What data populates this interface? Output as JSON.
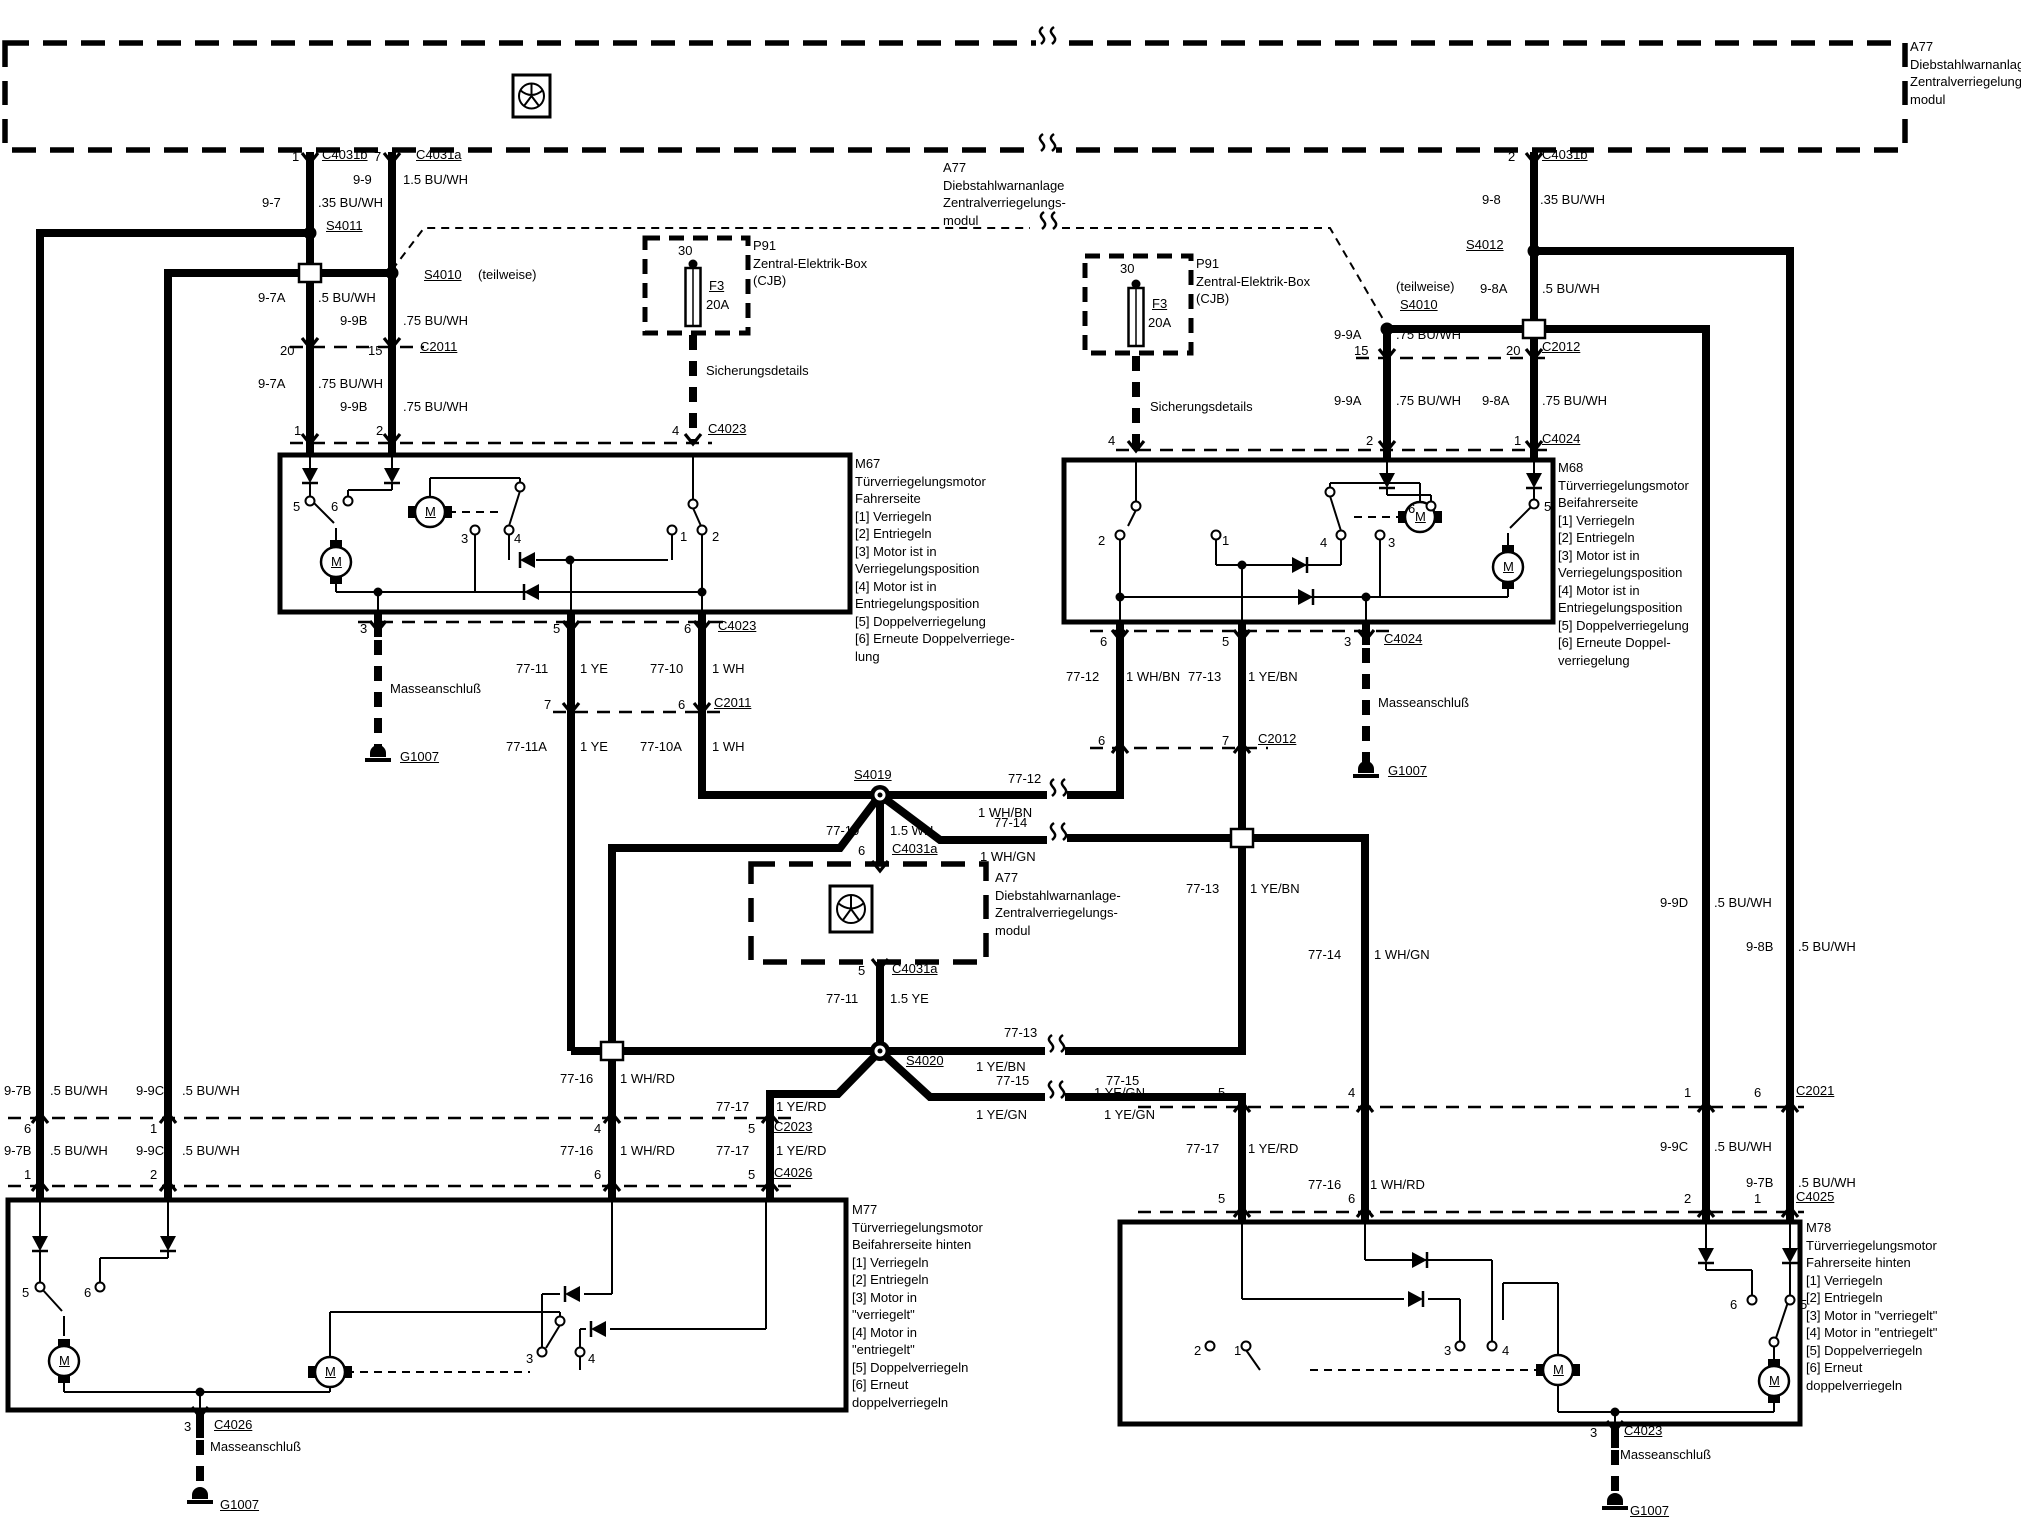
{
  "doc": {
    "type": "wiring-diagram",
    "language": "de",
    "subject": "Diebstahlwarnanlage / Zentralverriegelung (central locking system)",
    "ink": "#000000",
    "paper": "#ffffff"
  },
  "labels": [
    {
      "n": "module-a77-top-text",
      "t": "A77\nDiebstahlwarnanlage-/-\nZentralverriegelungs-\nmodul",
      "x": 1910,
      "y": 47,
      "b": 1
    },
    {
      "n": "module-a77-mid-top-text",
      "t": "A77\nDiebstahlwarnanlage\nZentralverriegelungs-\nmodul",
      "x": 943,
      "y": 168,
      "b": 1
    },
    {
      "n": "pin",
      "t": "1",
      "x": 292,
      "y": 158
    },
    {
      "n": "connector",
      "t": "C4031b",
      "x": 322,
      "y": 156,
      "u": 1
    },
    {
      "n": "pin",
      "t": "7",
      "x": 374,
      "y": 158
    },
    {
      "n": "connector",
      "t": "C4031a",
      "x": 416,
      "y": 156,
      "u": 1
    },
    {
      "n": "circuit",
      "t": "9-9",
      "x": 353,
      "y": 181
    },
    {
      "n": "wire-spec",
      "t": "1.5 BU/WH",
      "x": 403,
      "y": 181
    },
    {
      "n": "circuit",
      "t": "9-7",
      "x": 262,
      "y": 204
    },
    {
      "n": "wire-spec",
      "t": ".35 BU/WH",
      "x": 318,
      "y": 204
    },
    {
      "n": "splice",
      "t": "S4011",
      "x": 326,
      "y": 227,
      "u": 1
    },
    {
      "n": "splice",
      "t": "S4010",
      "x": 424,
      "y": 276,
      "u": 1
    },
    {
      "n": "note",
      "t": "(teilweise)",
      "x": 478,
      "y": 276
    },
    {
      "n": "circuit",
      "t": "9-7A",
      "x": 258,
      "y": 299
    },
    {
      "n": "wire-spec",
      "t": ".5 BU/WH",
      "x": 318,
      "y": 299
    },
    {
      "n": "circuit",
      "t": "9-9B",
      "x": 340,
      "y": 322
    },
    {
      "n": "wire-spec",
      "t": ".75 BU/WH",
      "x": 403,
      "y": 322
    },
    {
      "n": "pin",
      "t": "20",
      "x": 280,
      "y": 352
    },
    {
      "n": "pin",
      "t": "15",
      "x": 368,
      "y": 352
    },
    {
      "n": "connector",
      "t": "C2011",
      "x": 420,
      "y": 348,
      "u": 1
    },
    {
      "n": "circuit",
      "t": "9-7A",
      "x": 258,
      "y": 385
    },
    {
      "n": "wire-spec",
      "t": ".75 BU/WH",
      "x": 318,
      "y": 385
    },
    {
      "n": "circuit",
      "t": "9-9B",
      "x": 340,
      "y": 408
    },
    {
      "n": "wire-spec",
      "t": ".75 BU/WH",
      "x": 403,
      "y": 408
    },
    {
      "n": "pin",
      "t": "1",
      "x": 294,
      "y": 432
    },
    {
      "n": "pin",
      "t": "2",
      "x": 376,
      "y": 432
    },
    {
      "n": "pin",
      "t": "4",
      "x": 672,
      "y": 432
    },
    {
      "n": "connector",
      "t": "C4023",
      "x": 708,
      "y": 430,
      "u": 1
    },
    {
      "n": "fusebox-p91-left-text",
      "t": "P91\nZentral-Elektrik-Box\n(CJB)",
      "x": 753,
      "y": 246,
      "b": 1
    },
    {
      "n": "fuse-terminal",
      "t": "30",
      "x": 678,
      "y": 252
    },
    {
      "n": "fuse-id",
      "t": "F3",
      "x": 709,
      "y": 287,
      "u": 1
    },
    {
      "n": "fuse-rating",
      "t": "20A",
      "x": 706,
      "y": 306
    },
    {
      "n": "note",
      "t": "Sicherungsdetails",
      "x": 706,
      "y": 372
    },
    {
      "n": "module-m67-text",
      "t": "M67\nTürverriegelungsmotor\nFahrerseite\n[1] Verriegeln\n[2] Entriegeln\n[3] Motor ist in\nVerriegelungsposition\n[4] Motor ist in\nEntriegelungsposition\n[5] Doppelverriegelung\n[6] Erneute Doppelverriege-\nlung",
      "x": 855,
      "y": 464,
      "b": 1
    },
    {
      "n": "contact",
      "t": "5",
      "x": 293,
      "y": 508
    },
    {
      "n": "contact",
      "t": "6",
      "x": 331,
      "y": 508
    },
    {
      "n": "motor-letter",
      "t": "M",
      "x": 331,
      "y": 563,
      "u": 1
    },
    {
      "n": "motor-letter",
      "t": "M",
      "x": 425,
      "y": 513,
      "u": 1
    },
    {
      "n": "contact",
      "t": "3",
      "x": 461,
      "y": 540
    },
    {
      "n": "contact",
      "t": "4",
      "x": 514,
      "y": 540
    },
    {
      "n": "contact",
      "t": "1",
      "x": 680,
      "y": 538
    },
    {
      "n": "contact",
      "t": "2",
      "x": 712,
      "y": 538
    },
    {
      "n": "pin",
      "t": "3",
      "x": 360,
      "y": 630
    },
    {
      "n": "pin",
      "t": "5",
      "x": 553,
      "y": 630
    },
    {
      "n": "pin",
      "t": "6",
      "x": 684,
      "y": 630
    },
    {
      "n": "connector",
      "t": "C4023",
      "x": 718,
      "y": 627,
      "u": 1
    },
    {
      "n": "note",
      "t": "Masseanschluß",
      "x": 390,
      "y": 690
    },
    {
      "n": "ground",
      "t": "G1007",
      "x": 400,
      "y": 758,
      "u": 1
    },
    {
      "n": "circuit",
      "t": "77-11",
      "x": 516,
      "y": 670
    },
    {
      "n": "wire-spec",
      "t": "1 YE",
      "x": 580,
      "y": 670
    },
    {
      "n": "circuit",
      "t": "77-10",
      "x": 650,
      "y": 670
    },
    {
      "n": "wire-spec",
      "t": "1 WH",
      "x": 712,
      "y": 670
    },
    {
      "n": "pin",
      "t": "7",
      "x": 544,
      "y": 706
    },
    {
      "n": "pin",
      "t": "6",
      "x": 678,
      "y": 706
    },
    {
      "n": "connector",
      "t": "C2011",
      "x": 714,
      "y": 704,
      "u": 1
    },
    {
      "n": "circuit",
      "t": "77-11A",
      "x": 506,
      "y": 748
    },
    {
      "n": "wire-spec",
      "t": "1 YE",
      "x": 580,
      "y": 748
    },
    {
      "n": "circuit",
      "t": "77-10A",
      "x": 640,
      "y": 748
    },
    {
      "n": "wire-spec",
      "t": "1 WH",
      "x": 712,
      "y": 748
    },
    {
      "n": "splice",
      "t": "S4019",
      "x": 854,
      "y": 776,
      "u": 1
    },
    {
      "n": "circuit",
      "t": "77-12",
      "x": 1008,
      "y": 780
    },
    {
      "n": "wire-spec",
      "t": "1 WH/BN",
      "x": 978,
      "y": 814
    },
    {
      "n": "circuit",
      "t": "77-14",
      "x": 994,
      "y": 824
    },
    {
      "n": "wire-spec",
      "t": "1 WH/GN",
      "x": 980,
      "y": 858
    },
    {
      "n": "circuit",
      "t": "77-10",
      "x": 826,
      "y": 832
    },
    {
      "n": "wire-spec",
      "t": "1.5 WH",
      "x": 890,
      "y": 832
    },
    {
      "n": "pin",
      "t": "6",
      "x": 858,
      "y": 852
    },
    {
      "n": "connector",
      "t": "C4031a",
      "x": 892,
      "y": 850,
      "u": 1
    },
    {
      "n": "module-a77-mid-text",
      "t": "A77\nDiebstahlwarnanlage-\nZentralverriegelungs-\nmodul",
      "x": 995,
      "y": 878,
      "b": 1
    },
    {
      "n": "pin",
      "t": "5",
      "x": 858,
      "y": 972
    },
    {
      "n": "connector",
      "t": "C4031a",
      "x": 892,
      "y": 970,
      "u": 1
    },
    {
      "n": "circuit",
      "t": "77-11",
      "x": 826,
      "y": 1000
    },
    {
      "n": "wire-spec",
      "t": "1.5 YE",
      "x": 890,
      "y": 1000
    },
    {
      "n": "splice",
      "t": "S4020",
      "x": 906,
      "y": 1062,
      "u": 1
    },
    {
      "n": "circuit",
      "t": "77-13",
      "x": 1004,
      "y": 1034
    },
    {
      "n": "wire-spec",
      "t": "1 YE/BN",
      "x": 976,
      "y": 1068
    },
    {
      "n": "circuit",
      "t": "77-15",
      "x": 996,
      "y": 1082
    },
    {
      "n": "wire-spec",
      "t": "1 YE/GN",
      "x": 976,
      "y": 1116
    },
    {
      "n": "circuit",
      "t": "77-15",
      "x": 1106,
      "y": 1082
    },
    {
      "n": "wire-spec",
      "t": "1 YE/GN",
      "x": 1104,
      "y": 1116
    },
    {
      "n": "circuit",
      "t": "77-16",
      "x": 560,
      "y": 1080
    },
    {
      "n": "wire-spec",
      "t": "1 WH/RD",
      "x": 620,
      "y": 1080
    },
    {
      "n": "circuit",
      "t": "77-17",
      "x": 716,
      "y": 1108
    },
    {
      "n": "wire-spec",
      "t": "1 YE/RD",
      "x": 776,
      "y": 1108
    },
    {
      "n": "circuit",
      "t": "9-7B",
      "x": 4,
      "y": 1092
    },
    {
      "n": "wire-spec",
      "t": ".5 BU/WH",
      "x": 50,
      "y": 1092
    },
    {
      "n": "circuit",
      "t": "9-9C",
      "x": 136,
      "y": 1092
    },
    {
      "n": "wire-spec",
      "t": ".5 BU/WH",
      "x": 182,
      "y": 1092
    },
    {
      "n": "pin",
      "t": "6",
      "x": 24,
      "y": 1130
    },
    {
      "n": "pin",
      "t": "1",
      "x": 150,
      "y": 1130
    },
    {
      "n": "pin",
      "t": "4",
      "x": 594,
      "y": 1130
    },
    {
      "n": "pin",
      "t": "5",
      "x": 748,
      "y": 1130
    },
    {
      "n": "connector",
      "t": "C2023",
      "x": 774,
      "y": 1128,
      "u": 1
    },
    {
      "n": "circuit",
      "t": "9-7B",
      "x": 4,
      "y": 1152
    },
    {
      "n": "wire-spec",
      "t": ".5 BU/WH",
      "x": 50,
      "y": 1152
    },
    {
      "n": "circuit",
      "t": "9-9C",
      "x": 136,
      "y": 1152
    },
    {
      "n": "wire-spec",
      "t": ".5 BU/WH",
      "x": 182,
      "y": 1152
    },
    {
      "n": "circuit",
      "t": "77-16",
      "x": 560,
      "y": 1152
    },
    {
      "n": "wire-spec",
      "t": "1 WH/RD",
      "x": 620,
      "y": 1152
    },
    {
      "n": "circuit",
      "t": "77-17",
      "x": 716,
      "y": 1152
    },
    {
      "n": "wire-spec",
      "t": "1 YE/RD",
      "x": 776,
      "y": 1152
    },
    {
      "n": "pin",
      "t": "1",
      "x": 24,
      "y": 1176
    },
    {
      "n": "pin",
      "t": "2",
      "x": 150,
      "y": 1176
    },
    {
      "n": "pin",
      "t": "6",
      "x": 594,
      "y": 1176
    },
    {
      "n": "pin",
      "t": "5",
      "x": 748,
      "y": 1176
    },
    {
      "n": "connector",
      "t": "C4026",
      "x": 774,
      "y": 1174,
      "u": 1
    },
    {
      "n": "module-m77-text",
      "t": "M77\nTürverriegelungsmotor\nBeifahrerseite hinten\n[1] Verriegeln\n[2] Entriegeln\n[3] Motor in\n\"verriegelt\"\n[4] Motor in\n\"entriegelt\"\n[5] Doppelverriegeln\n[6] Erneut\ndoppelverriegeln",
      "x": 852,
      "y": 1210,
      "b": 1
    },
    {
      "n": "contact",
      "t": "5",
      "x": 22,
      "y": 1294
    },
    {
      "n": "contact",
      "t": "6",
      "x": 84,
      "y": 1294
    },
    {
      "n": "motor-letter",
      "t": "M",
      "x": 59,
      "y": 1362,
      "u": 1
    },
    {
      "n": "motor-letter",
      "t": "M",
      "x": 325,
      "y": 1373,
      "u": 1
    },
    {
      "n": "contact",
      "t": "3",
      "x": 526,
      "y": 1360
    },
    {
      "n": "contact",
      "t": "4",
      "x": 588,
      "y": 1360
    },
    {
      "n": "pin",
      "t": "3",
      "x": 184,
      "y": 1428
    },
    {
      "n": "connector",
      "t": "C4026",
      "x": 214,
      "y": 1426,
      "u": 1
    },
    {
      "n": "note",
      "t": "Masseanschluß",
      "x": 210,
      "y": 1448
    },
    {
      "n": "ground",
      "t": "G1007",
      "x": 220,
      "y": 1506,
      "u": 1
    },
    {
      "n": "pin",
      "t": "2",
      "x": 1508,
      "y": 158
    },
    {
      "n": "connector",
      "t": "C4031b",
      "x": 1542,
      "y": 156,
      "u": 1
    },
    {
      "n": "circuit",
      "t": "9-8",
      "x": 1482,
      "y": 201
    },
    {
      "n": "wire-spec",
      "t": ".35 BU/WH",
      "x": 1540,
      "y": 201
    },
    {
      "n": "splice",
      "t": "S4012",
      "x": 1466,
      "y": 246,
      "u": 1
    },
    {
      "n": "note",
      "t": "(teilweise)",
      "x": 1396,
      "y": 288
    },
    {
      "n": "splice",
      "t": "S4010",
      "x": 1400,
      "y": 306,
      "u": 1
    },
    {
      "n": "circuit",
      "t": "9-8A",
      "x": 1480,
      "y": 290
    },
    {
      "n": "wire-spec",
      "t": ".5 BU/WH",
      "x": 1542,
      "y": 290
    },
    {
      "n": "circuit",
      "t": "9-9A",
      "x": 1334,
      "y": 336
    },
    {
      "n": "wire-spec",
      "t": ".75 BU/WH",
      "x": 1396,
      "y": 336
    },
    {
      "n": "pin",
      "t": "15",
      "x": 1354,
      "y": 352
    },
    {
      "n": "pin",
      "t": "20",
      "x": 1506,
      "y": 352
    },
    {
      "n": "connector",
      "t": "C2012",
      "x": 1542,
      "y": 348,
      "u": 1
    },
    {
      "n": "circuit",
      "t": "9-9A",
      "x": 1334,
      "y": 402
    },
    {
      "n": "wire-spec",
      "t": ".75 BU/WH",
      "x": 1396,
      "y": 402
    },
    {
      "n": "circuit",
      "t": "9-8A",
      "x": 1482,
      "y": 402
    },
    {
      "n": "wire-spec",
      "t": ".75 BU/WH",
      "x": 1542,
      "y": 402
    },
    {
      "n": "pin",
      "t": "2",
      "x": 1366,
      "y": 442
    },
    {
      "n": "pin",
      "t": "1",
      "x": 1514,
      "y": 442
    },
    {
      "n": "connector",
      "t": "C4024",
      "x": 1542,
      "y": 440,
      "u": 1
    },
    {
      "n": "fusebox-p91-right-text",
      "t": "P91\nZentral-Elektrik-Box\n(CJB)",
      "x": 1196,
      "y": 264,
      "b": 1
    },
    {
      "n": "fuse-terminal",
      "t": "30",
      "x": 1120,
      "y": 270
    },
    {
      "n": "fuse-id",
      "t": "F3",
      "x": 1152,
      "y": 305,
      "u": 1
    },
    {
      "n": "fuse-rating",
      "t": "20A",
      "x": 1148,
      "y": 324
    },
    {
      "n": "note",
      "t": "Sicherungsdetails",
      "x": 1150,
      "y": 408
    },
    {
      "n": "pin",
      "t": "4",
      "x": 1108,
      "y": 442
    },
    {
      "n": "module-m68-text",
      "t": "M68\nTürverriegelungsmotor\nBeifahrerseite\n[1] Verriegeln\n[2] Entriegeln\n[3] Motor ist in\nVerriegelungsposition\n[4] Motor ist in\nEntriegelungsposition\n[5] Doppelverriegelung\n[6] Erneute Doppel-\nverriegelung",
      "x": 1558,
      "y": 468,
      "b": 1
    },
    {
      "n": "contact",
      "t": "2",
      "x": 1098,
      "y": 542
    },
    {
      "n": "contact",
      "t": "1",
      "x": 1222,
      "y": 542
    },
    {
      "n": "contact",
      "t": "4",
      "x": 1320,
      "y": 544
    },
    {
      "n": "contact",
      "t": "3",
      "x": 1388,
      "y": 544
    },
    {
      "n": "contact",
      "t": "6",
      "x": 1408,
      "y": 510
    },
    {
      "n": "contact",
      "t": "5",
      "x": 1544,
      "y": 508
    },
    {
      "n": "motor-letter",
      "t": "M",
      "x": 1503,
      "y": 568,
      "u": 1
    },
    {
      "n": "motor-letter",
      "t": "M",
      "x": 1415,
      "y": 518,
      "u": 1
    },
    {
      "n": "pin",
      "t": "6",
      "x": 1100,
      "y": 643
    },
    {
      "n": "pin",
      "t": "5",
      "x": 1222,
      "y": 643
    },
    {
      "n": "pin",
      "t": "3",
      "x": 1344,
      "y": 643
    },
    {
      "n": "connector",
      "t": "C4024",
      "x": 1384,
      "y": 640,
      "u": 1
    },
    {
      "n": "circuit",
      "t": "77-12",
      "x": 1066,
      "y": 678
    },
    {
      "n": "wire-spec",
      "t": "1 WH/BN",
      "x": 1126,
      "y": 678
    },
    {
      "n": "circuit",
      "t": "77-13",
      "x": 1188,
      "y": 678
    },
    {
      "n": "wire-spec",
      "t": "1 YE/BN",
      "x": 1248,
      "y": 678
    },
    {
      "n": "note",
      "t": "Masseanschluß",
      "x": 1378,
      "y": 704
    },
    {
      "n": "ground",
      "t": "G1007",
      "x": 1388,
      "y": 772,
      "u": 1
    },
    {
      "n": "pin",
      "t": "6",
      "x": 1098,
      "y": 742
    },
    {
      "n": "pin",
      "t": "7",
      "x": 1222,
      "y": 742
    },
    {
      "n": "connector",
      "t": "C2012",
      "x": 1258,
      "y": 740,
      "u": 1
    },
    {
      "n": "circuit",
      "t": "77-13",
      "x": 1186,
      "y": 890
    },
    {
      "n": "wire-spec",
      "t": "1 YE/BN",
      "x": 1250,
      "y": 890
    },
    {
      "n": "circuit",
      "t": "77-14",
      "x": 1308,
      "y": 956
    },
    {
      "n": "wire-spec",
      "t": "1 WH/GN",
      "x": 1374,
      "y": 956
    },
    {
      "n": "circuit",
      "t": "9-9D",
      "x": 1660,
      "y": 904
    },
    {
      "n": "wire-spec",
      "t": ".5 BU/WH",
      "x": 1714,
      "y": 904
    },
    {
      "n": "circuit",
      "t": "9-8B",
      "x": 1746,
      "y": 948
    },
    {
      "n": "wire-spec",
      "t": ".5 BU/WH",
      "x": 1798,
      "y": 948
    },
    {
      "n": "wire-spec",
      "t": "1 YE/GN",
      "x": 1094,
      "y": 1094
    },
    {
      "n": "pin",
      "t": "5",
      "x": 1218,
      "y": 1094
    },
    {
      "n": "pin",
      "t": "4",
      "x": 1348,
      "y": 1094
    },
    {
      "n": "pin",
      "t": "1",
      "x": 1684,
      "y": 1094
    },
    {
      "n": "pin",
      "t": "6",
      "x": 1754,
      "y": 1094
    },
    {
      "n": "connector",
      "t": "C2021",
      "x": 1796,
      "y": 1092,
      "u": 1
    },
    {
      "n": "circuit",
      "t": "77-17",
      "x": 1186,
      "y": 1150
    },
    {
      "n": "wire-spec",
      "t": "1 YE/RD",
      "x": 1248,
      "y": 1150
    },
    {
      "n": "circuit",
      "t": "9-9C",
      "x": 1660,
      "y": 1148
    },
    {
      "n": "wire-spec",
      "t": ".5 BU/WH",
      "x": 1714,
      "y": 1148
    },
    {
      "n": "circuit",
      "t": "77-16",
      "x": 1308,
      "y": 1186
    },
    {
      "n": "wire-spec",
      "t": "1 WH/RD",
      "x": 1370,
      "y": 1186
    },
    {
      "n": "circuit",
      "t": "9-7B",
      "x": 1746,
      "y": 1184
    },
    {
      "n": "wire-spec",
      "t": ".5 BU/WH",
      "x": 1798,
      "y": 1184
    },
    {
      "n": "pin",
      "t": "5",
      "x": 1218,
      "y": 1200
    },
    {
      "n": "pin",
      "t": "6",
      "x": 1348,
      "y": 1200
    },
    {
      "n": "pin",
      "t": "2",
      "x": 1684,
      "y": 1200
    },
    {
      "n": "pin",
      "t": "1",
      "x": 1754,
      "y": 1200
    },
    {
      "n": "connector",
      "t": "C4025",
      "x": 1796,
      "y": 1198,
      "u": 1
    },
    {
      "n": "module-m78-text",
      "t": "M78\nTürverriegelungsmotor\nFahrerseite hinten\n[1] Verriegeln\n[2] Entriegeln\n[3] Motor in \"verriegelt\"\n[4] Motor in \"entriegelt\"\n[5] Doppelverriegeln\n[6] Erneut\ndoppelverriegeln",
      "x": 1806,
      "y": 1228,
      "b": 1
    },
    {
      "n": "contact",
      "t": "2",
      "x": 1194,
      "y": 1352
    },
    {
      "n": "contact",
      "t": "1",
      "x": 1234,
      "y": 1352
    },
    {
      "n": "contact",
      "t": "3",
      "x": 1444,
      "y": 1352
    },
    {
      "n": "contact",
      "t": "4",
      "x": 1502,
      "y": 1352
    },
    {
      "n": "contact",
      "t": "6",
      "x": 1730,
      "y": 1306
    },
    {
      "n": "contact",
      "t": "5",
      "x": 1800,
      "y": 1306
    },
    {
      "n": "motor-letter",
      "t": "M",
      "x": 1553,
      "y": 1371,
      "u": 1
    },
    {
      "n": "motor-letter",
      "t": "M",
      "x": 1769,
      "y": 1382,
      "u": 1
    },
    {
      "n": "pin",
      "t": "3",
      "x": 1590,
      "y": 1434
    },
    {
      "n": "connector",
      "t": "C4023",
      "x": 1624,
      "y": 1432,
      "u": 1
    },
    {
      "n": "note",
      "t": "Masseanschluß",
      "x": 1620,
      "y": 1456
    },
    {
      "n": "ground",
      "t": "G1007",
      "x": 1630,
      "y": 1512,
      "u": 1
    }
  ]
}
